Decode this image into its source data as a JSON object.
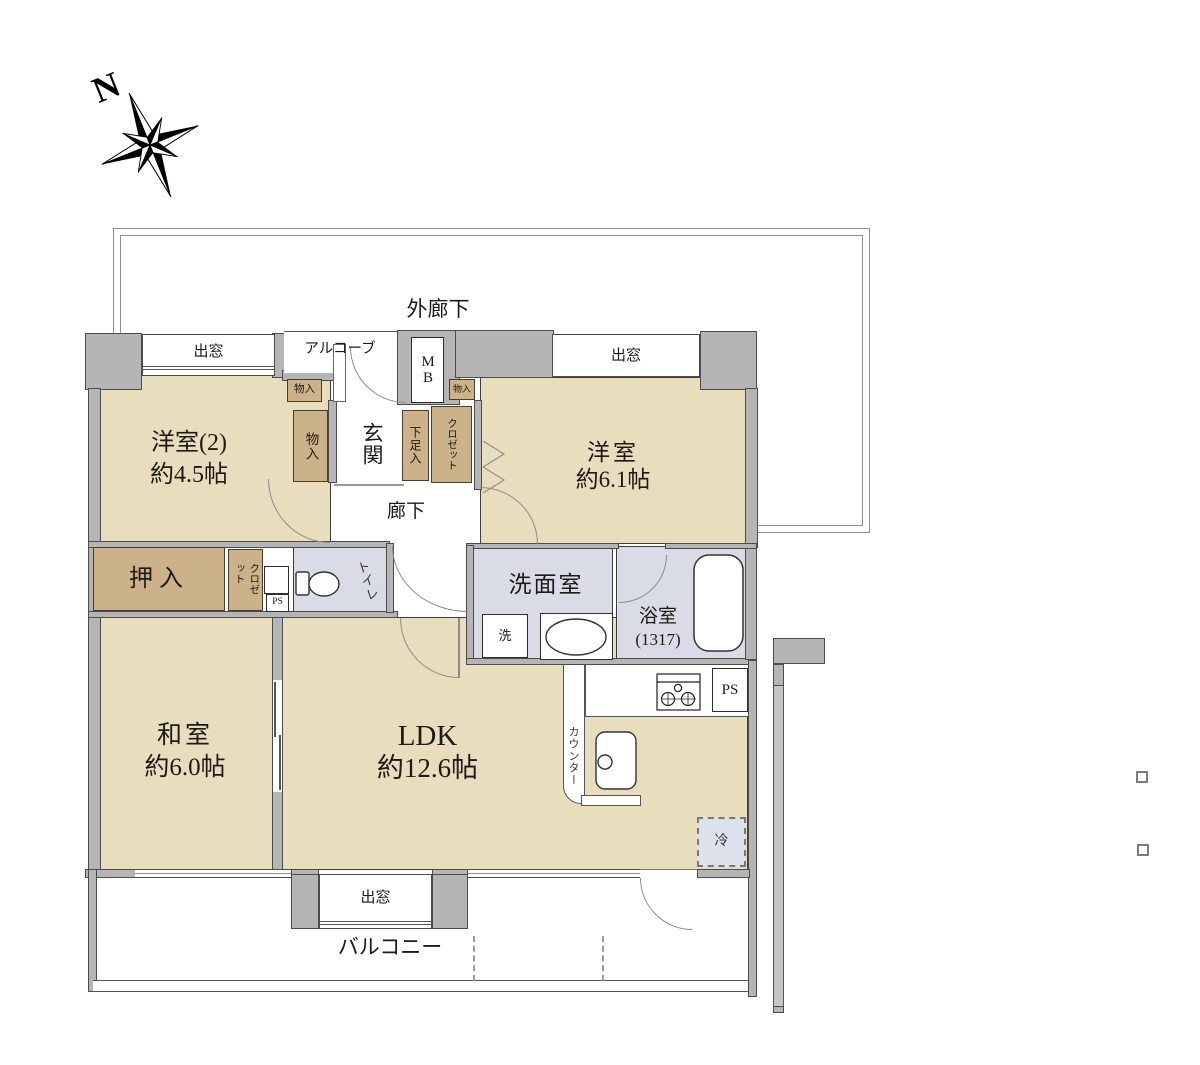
{
  "compass": {
    "north_label": "N"
  },
  "labels": {
    "outer_corridor": "外廊下",
    "balcony": "バルコニー",
    "bay_window": "出窓",
    "alcove": "アルコーブ",
    "meter_box": "MB",
    "entrance": "玄関",
    "shoe_cabinet": "下足入",
    "closet": "クロゼット",
    "storage": "物入",
    "hallway": "廊下",
    "futon_closet": "押入",
    "pipe_space": "PS",
    "toilet": "トイレ",
    "washroom": "洗面室",
    "washer": "洗",
    "bathroom": "浴室",
    "bathroom_size": "(1317)",
    "kitchen_counter": "カウンター",
    "refrigerator": "冷"
  },
  "rooms": {
    "western_room_2": {
      "name": "洋室(2)",
      "area": "約4.5帖"
    },
    "western_room": {
      "name": "洋室",
      "area": "約6.1帖"
    },
    "japanese_room": {
      "name": "和室",
      "area": "約6.0帖"
    },
    "ldk": {
      "name": "LDK",
      "area": "約12.6帖"
    }
  },
  "colors": {
    "room_fill": "#e8ddbc",
    "closet_fill": "#ccb289",
    "wet_area_fill": "#d9dce6",
    "wall_fill": "#b5b5b5",
    "line": "#3d3d3d"
  }
}
